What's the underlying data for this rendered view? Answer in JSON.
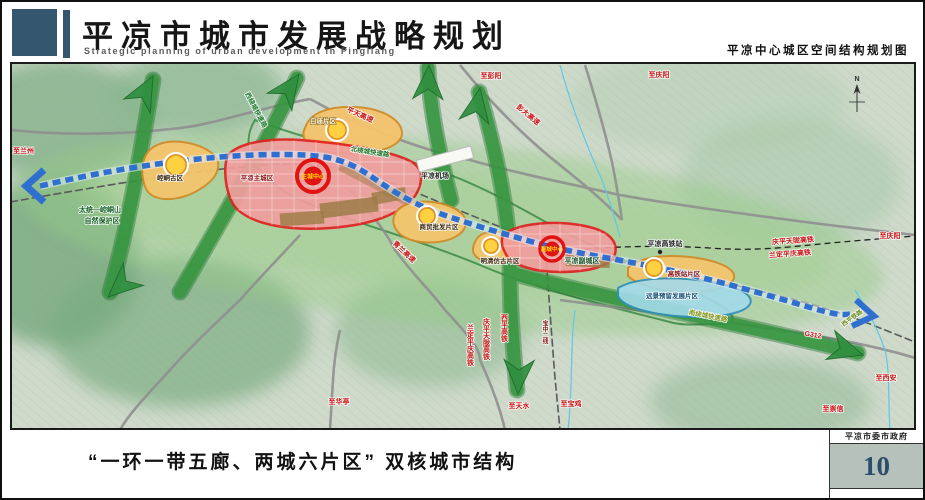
{
  "header": {
    "title_cn": "平凉市城市发展战略规划",
    "title_en": "Strategic planning of urban development in Pingliang",
    "right_caption": "平凉中心城区空间结构规划图"
  },
  "footer": {
    "caption": "“一环一带五廊、两城六片区” 双核城市结构",
    "gov": "平凉市委市政府",
    "page_number": "10"
  },
  "map": {
    "zones": {
      "baimiao": "白庙片区",
      "kongtong": "崆峒古区",
      "main_city": "平凉主城区",
      "main_center": "主城中心",
      "shangmao": "商贸批发片区",
      "mingqing": "明清仿古片区",
      "sub_city": "平凉副城区",
      "sub_center": "副城中心",
      "gaotie_zone": "高铁站片区",
      "yuanjing": "远景预留发展片区"
    },
    "facilities": {
      "airport": "平凉机场",
      "hsr_station": "平凉高铁站"
    },
    "roads": {
      "pengda": "彭大高速",
      "pingtian": "平天高速",
      "qinglan": "青兰高速",
      "g312": "G312",
      "xiping_rail": "西平铁路",
      "west_ring": "西绕城快速路",
      "north_ring": "北绕城快速路",
      "south_ring": "南绕城快速路",
      "baozhong": "宝中二线",
      "qptl_hsr": "庆平天陇高铁",
      "ldpq_hsr": "兰定平庆高铁",
      "xiping_hsr": "西平高铁"
    },
    "directions": {
      "lanzhou": "至兰州",
      "pengyang": "至彭阳",
      "qingyang": "至庆阳",
      "qingyang2": "至庆阳",
      "xian": "至西安",
      "chongxin": "至崇信",
      "huating": "至华亭",
      "tianshui": "至天水",
      "baoji": "至宝鸡"
    },
    "nature": {
      "reserve_line1": "太统—崆峒山",
      "reserve_line2": "自然保护区"
    },
    "compass_n": "N"
  },
  "colors": {
    "header_blue": "#34566f",
    "page_num_blue": "#2e4d6b",
    "zone_red": "#e02020",
    "zone_orange": "#d08c28",
    "corridor_green": "#2f8f3f",
    "transit_blue": "#2e6fd0"
  }
}
